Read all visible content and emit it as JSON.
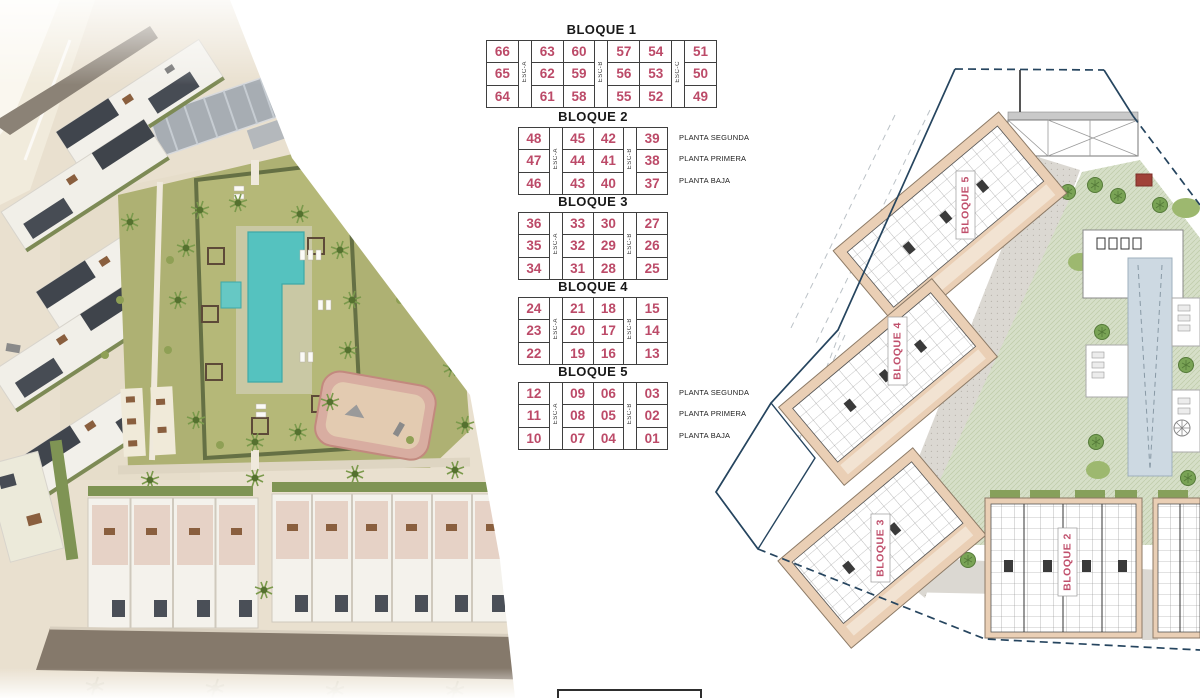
{
  "unit_tables": [
    {
      "title": "BLOQUE 1",
      "escaleras": [
        "ESC-A",
        "ESC-B",
        "ESC-C"
      ],
      "column_pattern": [
        "unit",
        "esc",
        "unit",
        "unit",
        "esc",
        "unit",
        "unit",
        "esc",
        "unit"
      ],
      "rows": [
        [
          "66",
          "63",
          "60",
          "57",
          "54",
          "51"
        ],
        [
          "65",
          "62",
          "59",
          "56",
          "53",
          "50"
        ],
        [
          "64",
          "61",
          "58",
          "55",
          "52",
          "49"
        ]
      ],
      "planta_labels": []
    },
    {
      "title": "BLOQUE 2",
      "escaleras": [
        "ESC-A",
        "ESC-B"
      ],
      "column_pattern": [
        "unit",
        "esc",
        "unit",
        "unit",
        "esc",
        "unit"
      ],
      "rows": [
        [
          "48",
          "45",
          "42",
          "39"
        ],
        [
          "47",
          "44",
          "41",
          "38"
        ],
        [
          "46",
          "43",
          "40",
          "37"
        ]
      ],
      "planta_labels": [
        "PLANTA SEGUNDA",
        "PLANTA PRIMERA",
        "PLANTA BAJA"
      ]
    },
    {
      "title": "BLOQUE 3",
      "escaleras": [
        "ESC-A",
        "ESC-B"
      ],
      "column_pattern": [
        "unit",
        "esc",
        "unit",
        "unit",
        "esc",
        "unit"
      ],
      "rows": [
        [
          "36",
          "33",
          "30",
          "27"
        ],
        [
          "35",
          "32",
          "29",
          "26"
        ],
        [
          "34",
          "31",
          "28",
          "25"
        ]
      ],
      "planta_labels": []
    },
    {
      "title": "BLOQUE 4",
      "escaleras": [
        "ESC-A",
        "ESC-B"
      ],
      "column_pattern": [
        "unit",
        "esc",
        "unit",
        "unit",
        "esc",
        "unit"
      ],
      "rows": [
        [
          "24",
          "21",
          "18",
          "15"
        ],
        [
          "23",
          "20",
          "17",
          "14"
        ],
        [
          "22",
          "19",
          "16",
          "13"
        ]
      ],
      "planta_labels": []
    },
    {
      "title": "BLOQUE 5",
      "escaleras": [
        "ESC-A",
        "ESC-B"
      ],
      "column_pattern": [
        "unit",
        "esc",
        "unit",
        "unit",
        "esc",
        "unit"
      ],
      "rows": [
        [
          "12",
          "09",
          "06",
          "03"
        ],
        [
          "11",
          "08",
          "05",
          "02"
        ],
        [
          "10",
          "07",
          "04",
          "01"
        ]
      ],
      "planta_labels": [
        "PLANTA SEGUNDA",
        "PLANTA PRIMERA",
        "PLANTA BAJA"
      ]
    }
  ],
  "site_plan": {
    "block_labels": [
      "BLOQUE 5",
      "BLOQUE 4",
      "BLOQUE 3",
      "BLOQUE 2"
    ]
  },
  "colors": {
    "unit_number": "#bc4a68",
    "block_label": "#c0506c",
    "parcel_boundary": "#26455f",
    "building_tan": "#eacfb5",
    "plan_pool": "#cdd9e2",
    "render_pool": "#55c2bf",
    "lawn": "#aab173",
    "tree_green": "#6f9b4f"
  }
}
